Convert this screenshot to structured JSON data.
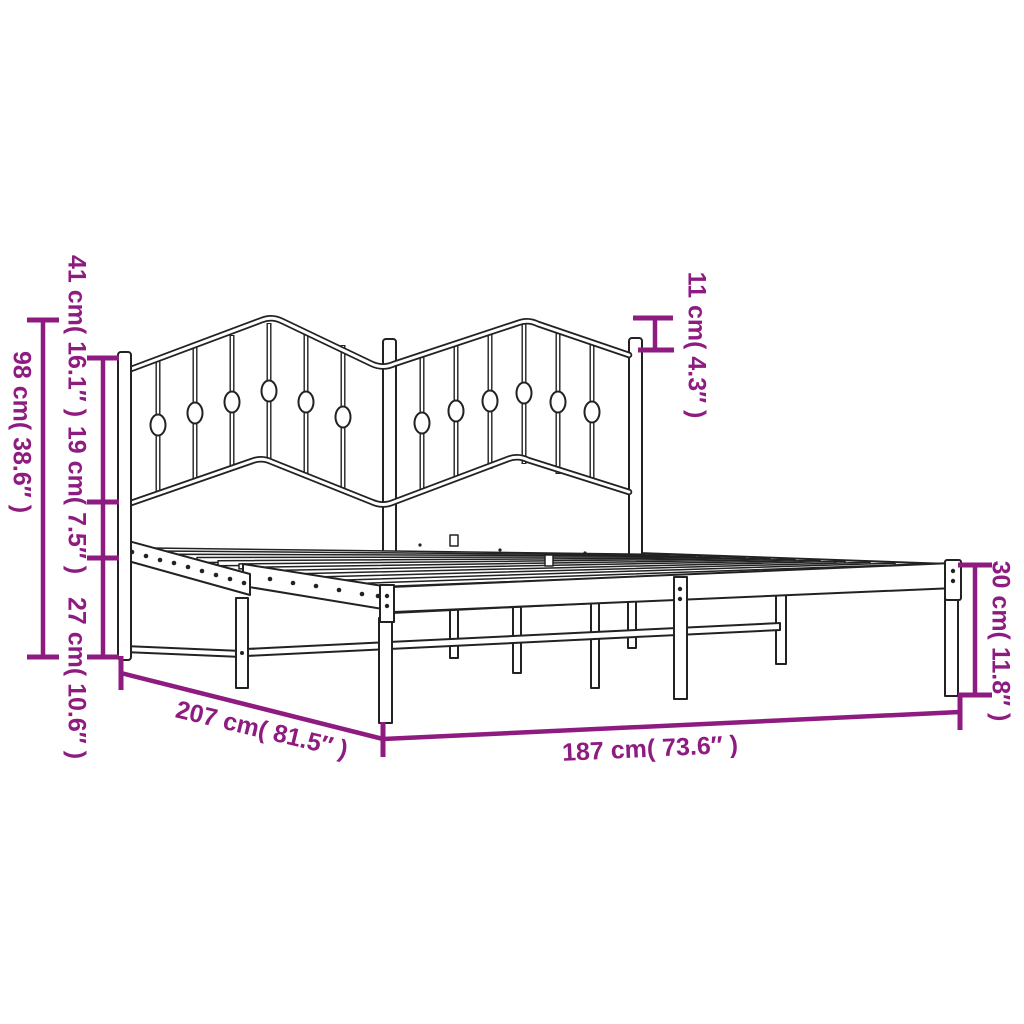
{
  "image": {
    "subject": "Metal bed frame with decorative headboard — product dimension diagram",
    "background_color": "#ffffff",
    "line_color": "#222222",
    "accent_color": "#8e1b80"
  },
  "dimensions": {
    "total_height": {
      "cm": 98,
      "in": 38.6,
      "label": "98 cm( 38.6″ )"
    },
    "headboard_upper": {
      "cm": 41,
      "in": 16.1,
      "label": "41 cm( 16.1″ )"
    },
    "headboard_lower": {
      "cm": 19,
      "in": 7.5,
      "label": "19 cm( 7.5″ )"
    },
    "ground_clearance": {
      "cm": 27,
      "in": 10.6,
      "label": "27 cm( 10.6″ )"
    },
    "peak_above_post": {
      "cm": 11,
      "in": 4.3,
      "label": "11 cm( 4.3″ )"
    },
    "side_rail_height": {
      "cm": 30,
      "in": 11.8,
      "label": "30 cm( 11.8″ )"
    },
    "total_length": {
      "cm": 207,
      "in": 81.5,
      "label": "207 cm( 81.5″ )"
    },
    "inner_length": {
      "cm": 187,
      "in": 73.6,
      "label": "187 cm( 73.6″ )"
    }
  }
}
